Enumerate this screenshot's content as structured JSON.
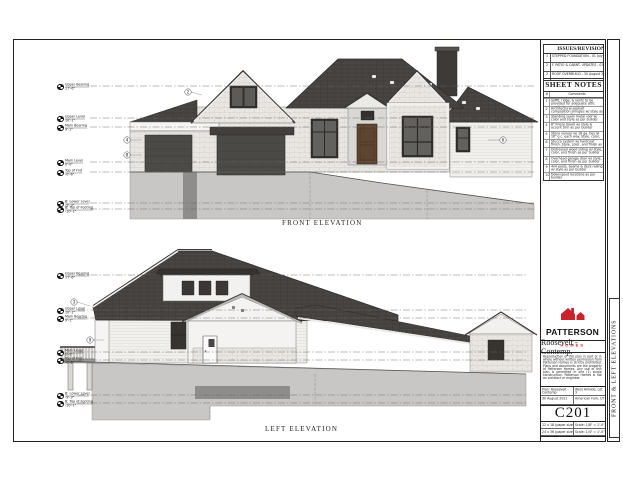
{
  "sheet": {
    "side_label": "FRONT & LEFT ELEVATIONS"
  },
  "titleblock": {
    "issues_header": "ISSUES/REVISIONS",
    "revisions": [
      {
        "num": "1",
        "text": "STEPPED FOUNDATION - 01 July 2021"
      },
      {
        "num": "2",
        "text": "F. PATIO & CABNT. UPDATES - 07 July 2021"
      },
      {
        "num": "3",
        "text": "ROOF OVERBUILD - 30 August 2021"
      }
    ],
    "notes_header": "SHEET NOTES",
    "notes_cols": {
      "num": "#",
      "comments": "Comments"
    },
    "notes": [
      {
        "num": "1",
        "text": "Soffit, ridge, & vents to be provided for adequate attic ventilation. Ventilation to equal 1/150 of attic space as per IRC"
      },
      {
        "num": "2",
        "text": "Architectural asphalt composition shingles w/ style as per builder. Shingles to be class 'A'"
      },
      {
        "num": "3",
        "text": "Standing seam metal roof w/ color and style as per builder"
      },
      {
        "num": "4",
        "text": "8\" Frieze board w/ style & accent trim as per builder"
      },
      {
        "num": "5",
        "text": "Stone veneer w/ 18 ga. ties @ 16\" o.c. each way. Style, color, and finish as per builder"
      },
      {
        "num": "6",
        "text": "Stucco system w/ hardcoat finish. Style, color, and finish as per builder"
      },
      {
        "num": "7",
        "text": "Distressed wood siding w/ style, color, and finish as per builder"
      },
      {
        "num": "8",
        "text": "Overhead garage door w/ style, color, and finish as per builder"
      },
      {
        "num": "9",
        "text": "4x4 posts, beams & deck railing w/ style as per builder"
      },
      {
        "num": "10",
        "text": "Downspout locations as per builder"
      }
    ],
    "brand": {
      "name": "PATTERSON",
      "sub": "HOMES"
    },
    "plan_title": "Roosevelt - Contemp.",
    "disclaimer": "Reproduction of this plan in part or in whole without written permission from Patterson Homes is strictly prohibited. Plans and documents are the property of Patterson Homes. Any use of this plan is permitted in one (1) single construction. Patterson Homes is not an architect or engineer.",
    "info": {
      "plan": "Plan: Roosevelt - Contemp",
      "date": "30 August 2021",
      "lot": "West Hillside, Lot 3",
      "city": "American Fork, UT"
    },
    "sheet_number": "C201",
    "scales": [
      {
        "paper": "12 x 18 (paper size)",
        "scale": "Scale: 1/8\" = 1'-0\""
      },
      {
        "paper": "24 x 36 (paper size)",
        "scale": "Scale: 1/4\" = 1'-0\""
      }
    ]
  },
  "drawings": {
    "front": {
      "title": "FRONT ELEVATION",
      "levels": [
        {
          "name": "Upper Bearing",
          "elev": "17'-6\""
        },
        {
          "name": "Upper Level",
          "elev": "10'-1\""
        },
        {
          "name": "Main Bearing",
          "elev": "9'-1\""
        },
        {
          "name": "Main Level",
          "elev": "0'-0\""
        },
        {
          "name": "Top of Fnd",
          "elev": "-0'-6\""
        },
        {
          "name": "B: Lower Level",
          "elev": "-9'-3\""
        },
        {
          "name": "B: Top of Footing",
          "elev": "-10'-1\""
        }
      ],
      "tags": [
        "4",
        "8",
        "2",
        "6"
      ]
    },
    "left": {
      "title": "LEFT ELEVATION",
      "levels": [
        {
          "name": "Upper Bearing",
          "elev": "17'-6\""
        },
        {
          "name": "Upper Level",
          "elev": "10'-1\""
        },
        {
          "name": "Main Bearing",
          "elev": "9'-1\""
        },
        {
          "name": "Main Level",
          "elev": "0'-0\""
        },
        {
          "name": "Top of Fnd",
          "elev": "-0'-6\""
        },
        {
          "name": "B: Lower Level",
          "elev": "-9'-3\""
        },
        {
          "name": "B: Top of Footing",
          "elev": "-10'-1\""
        }
      ],
      "tags": [
        "3",
        "9"
      ]
    }
  },
  "colors": {
    "accent_red": "#C8242B",
    "roof": "#45413E",
    "stone": "#E9E6E2",
    "siding": "#F1F0ED",
    "garage_door": "#4C4A47",
    "entry_door": "#5E4530",
    "foundation": "#C9C7C5",
    "line": "#222222"
  }
}
